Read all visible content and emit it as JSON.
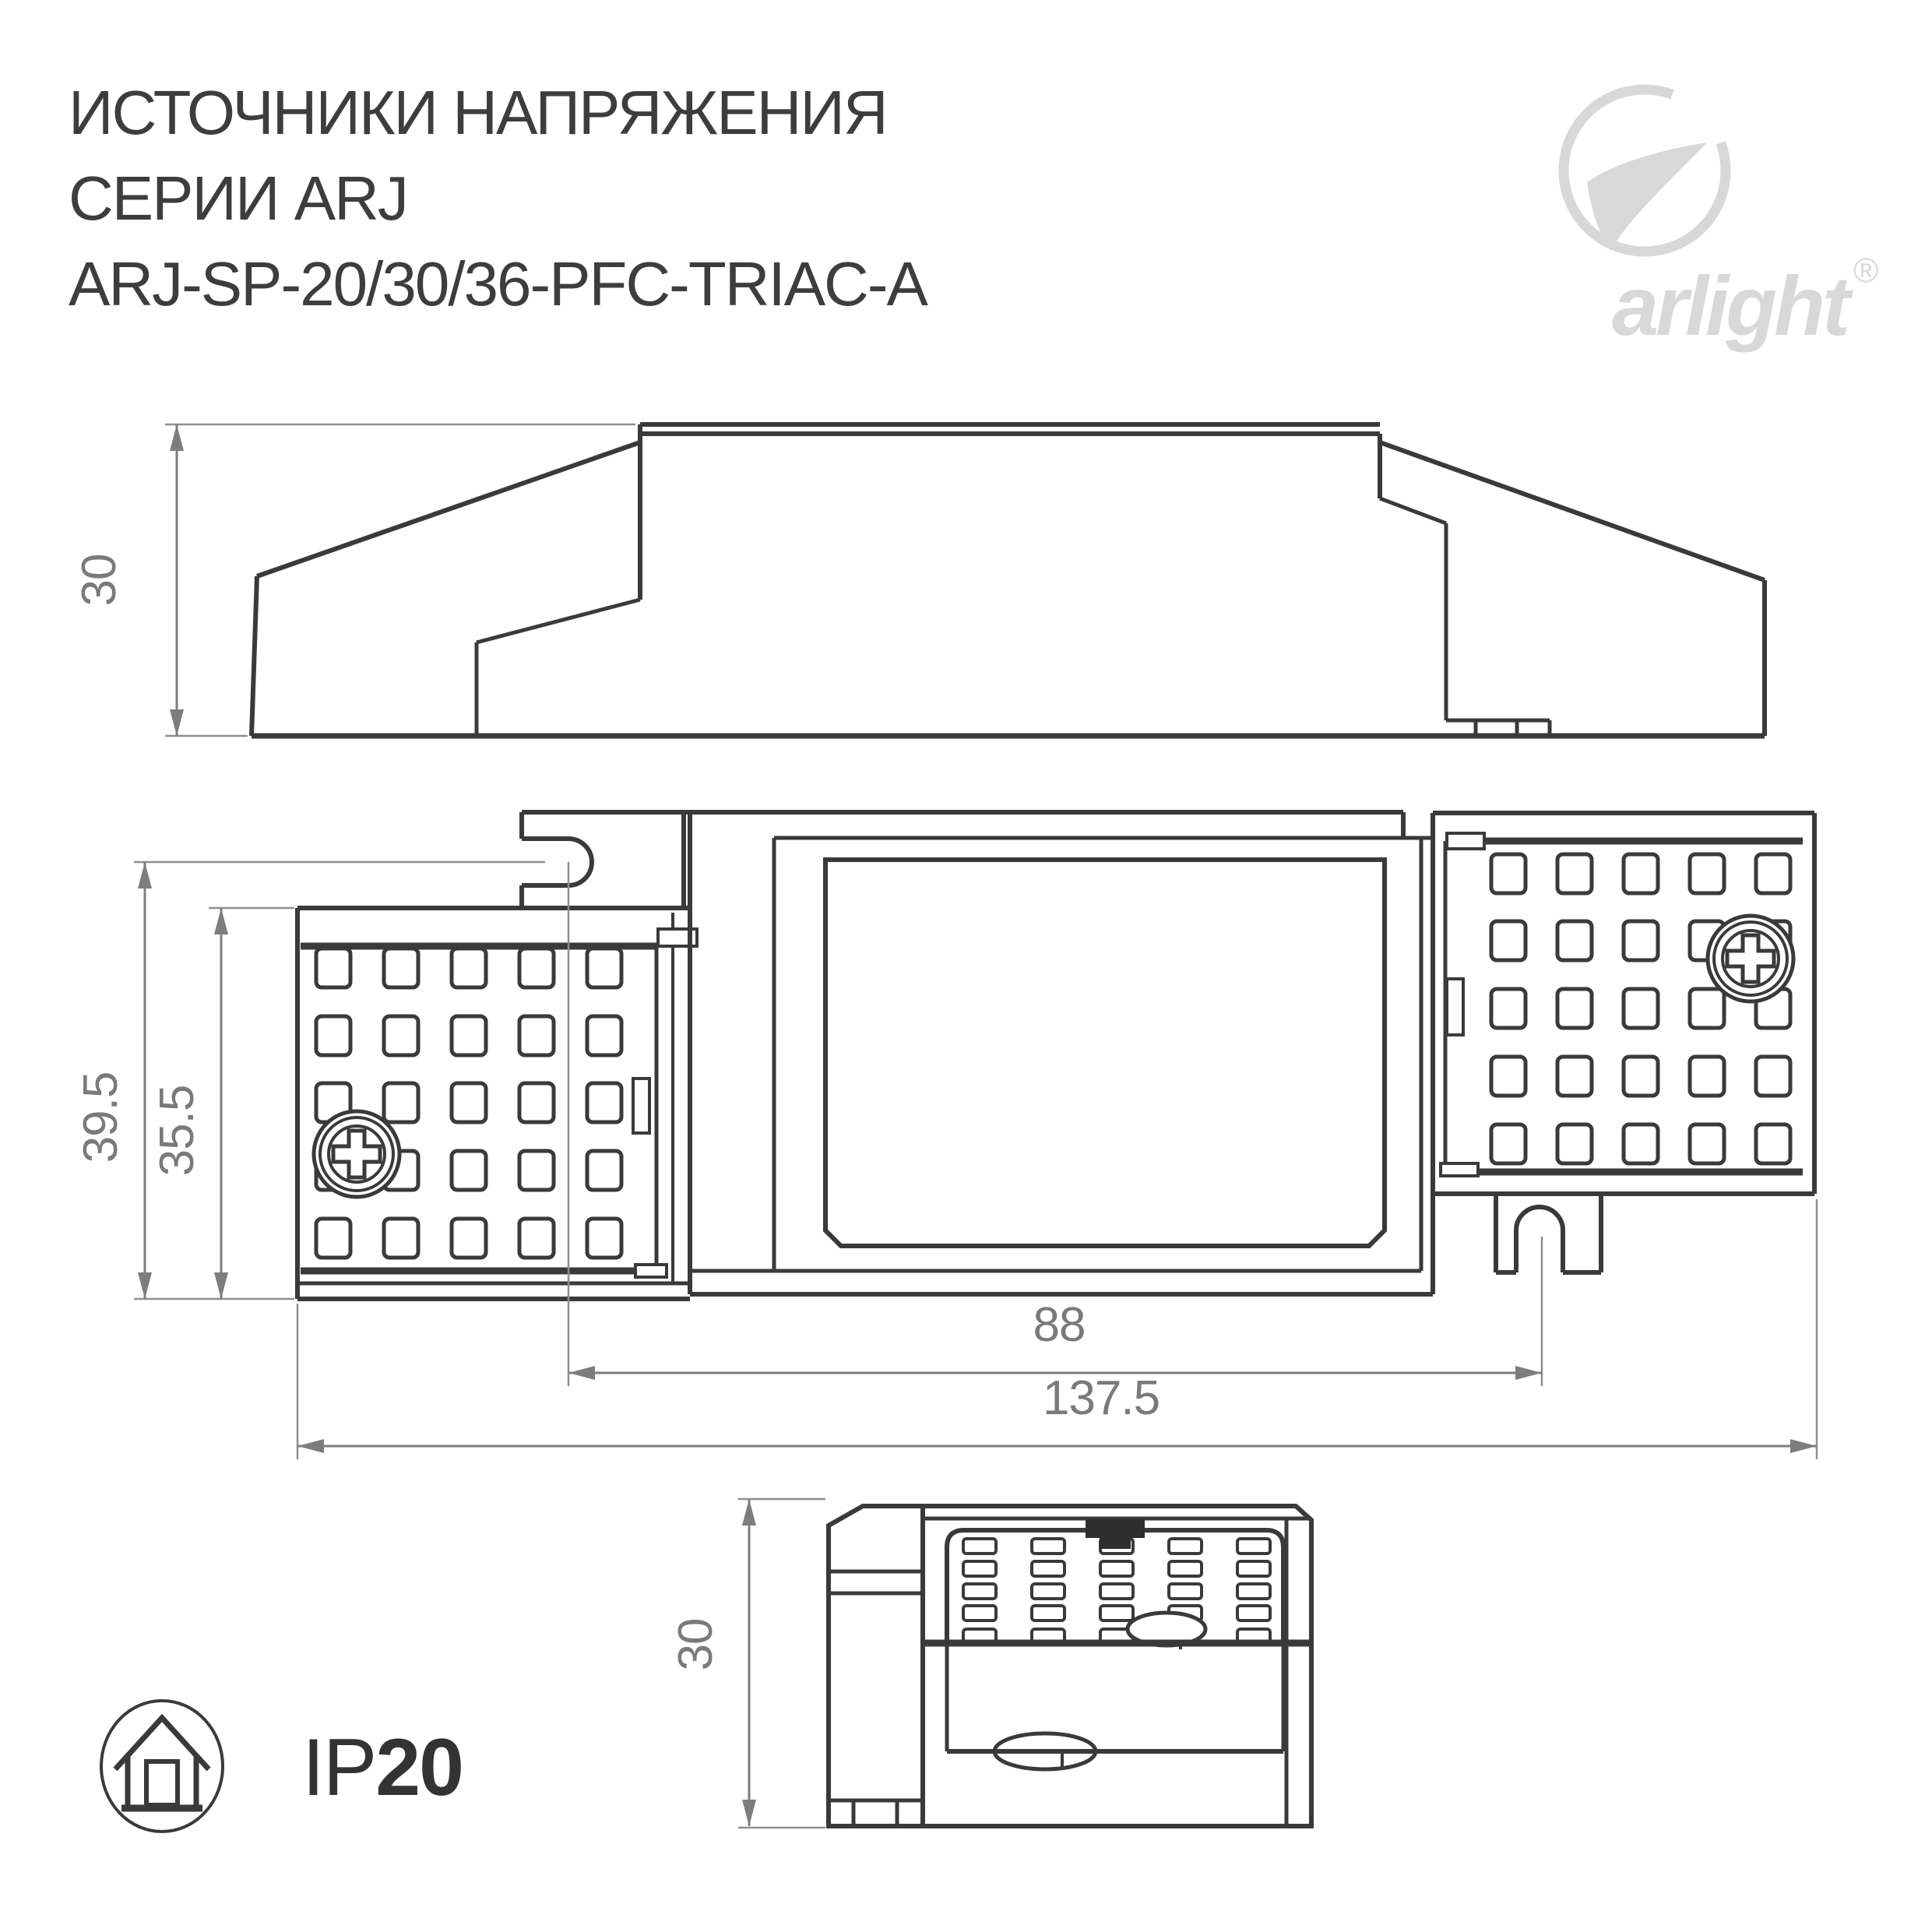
{
  "title": {
    "line1": "ИСТОЧНИКИ НАПРЯЖЕНИЯ",
    "line2": "СЕРИИ ARJ",
    "line3": "ARJ-SP-20/30/36-PFC-TRIAC-A"
  },
  "brand": {
    "wordmark": "arlight",
    "registered": "®"
  },
  "ip_rating": {
    "prefix": "IP",
    "value": "20"
  },
  "dimensions": {
    "side_view_height": "30",
    "front_total_height": "39.5",
    "front_body_height": "35.5",
    "front_slot_spacing": "88",
    "front_total_width": "137.5",
    "end_view_height": "30"
  },
  "colors": {
    "drawing_line": "#3a3a3a",
    "dimension": "#7d7d7d",
    "logo": "#d8d8d8",
    "title_text": "#3d3d3d"
  }
}
